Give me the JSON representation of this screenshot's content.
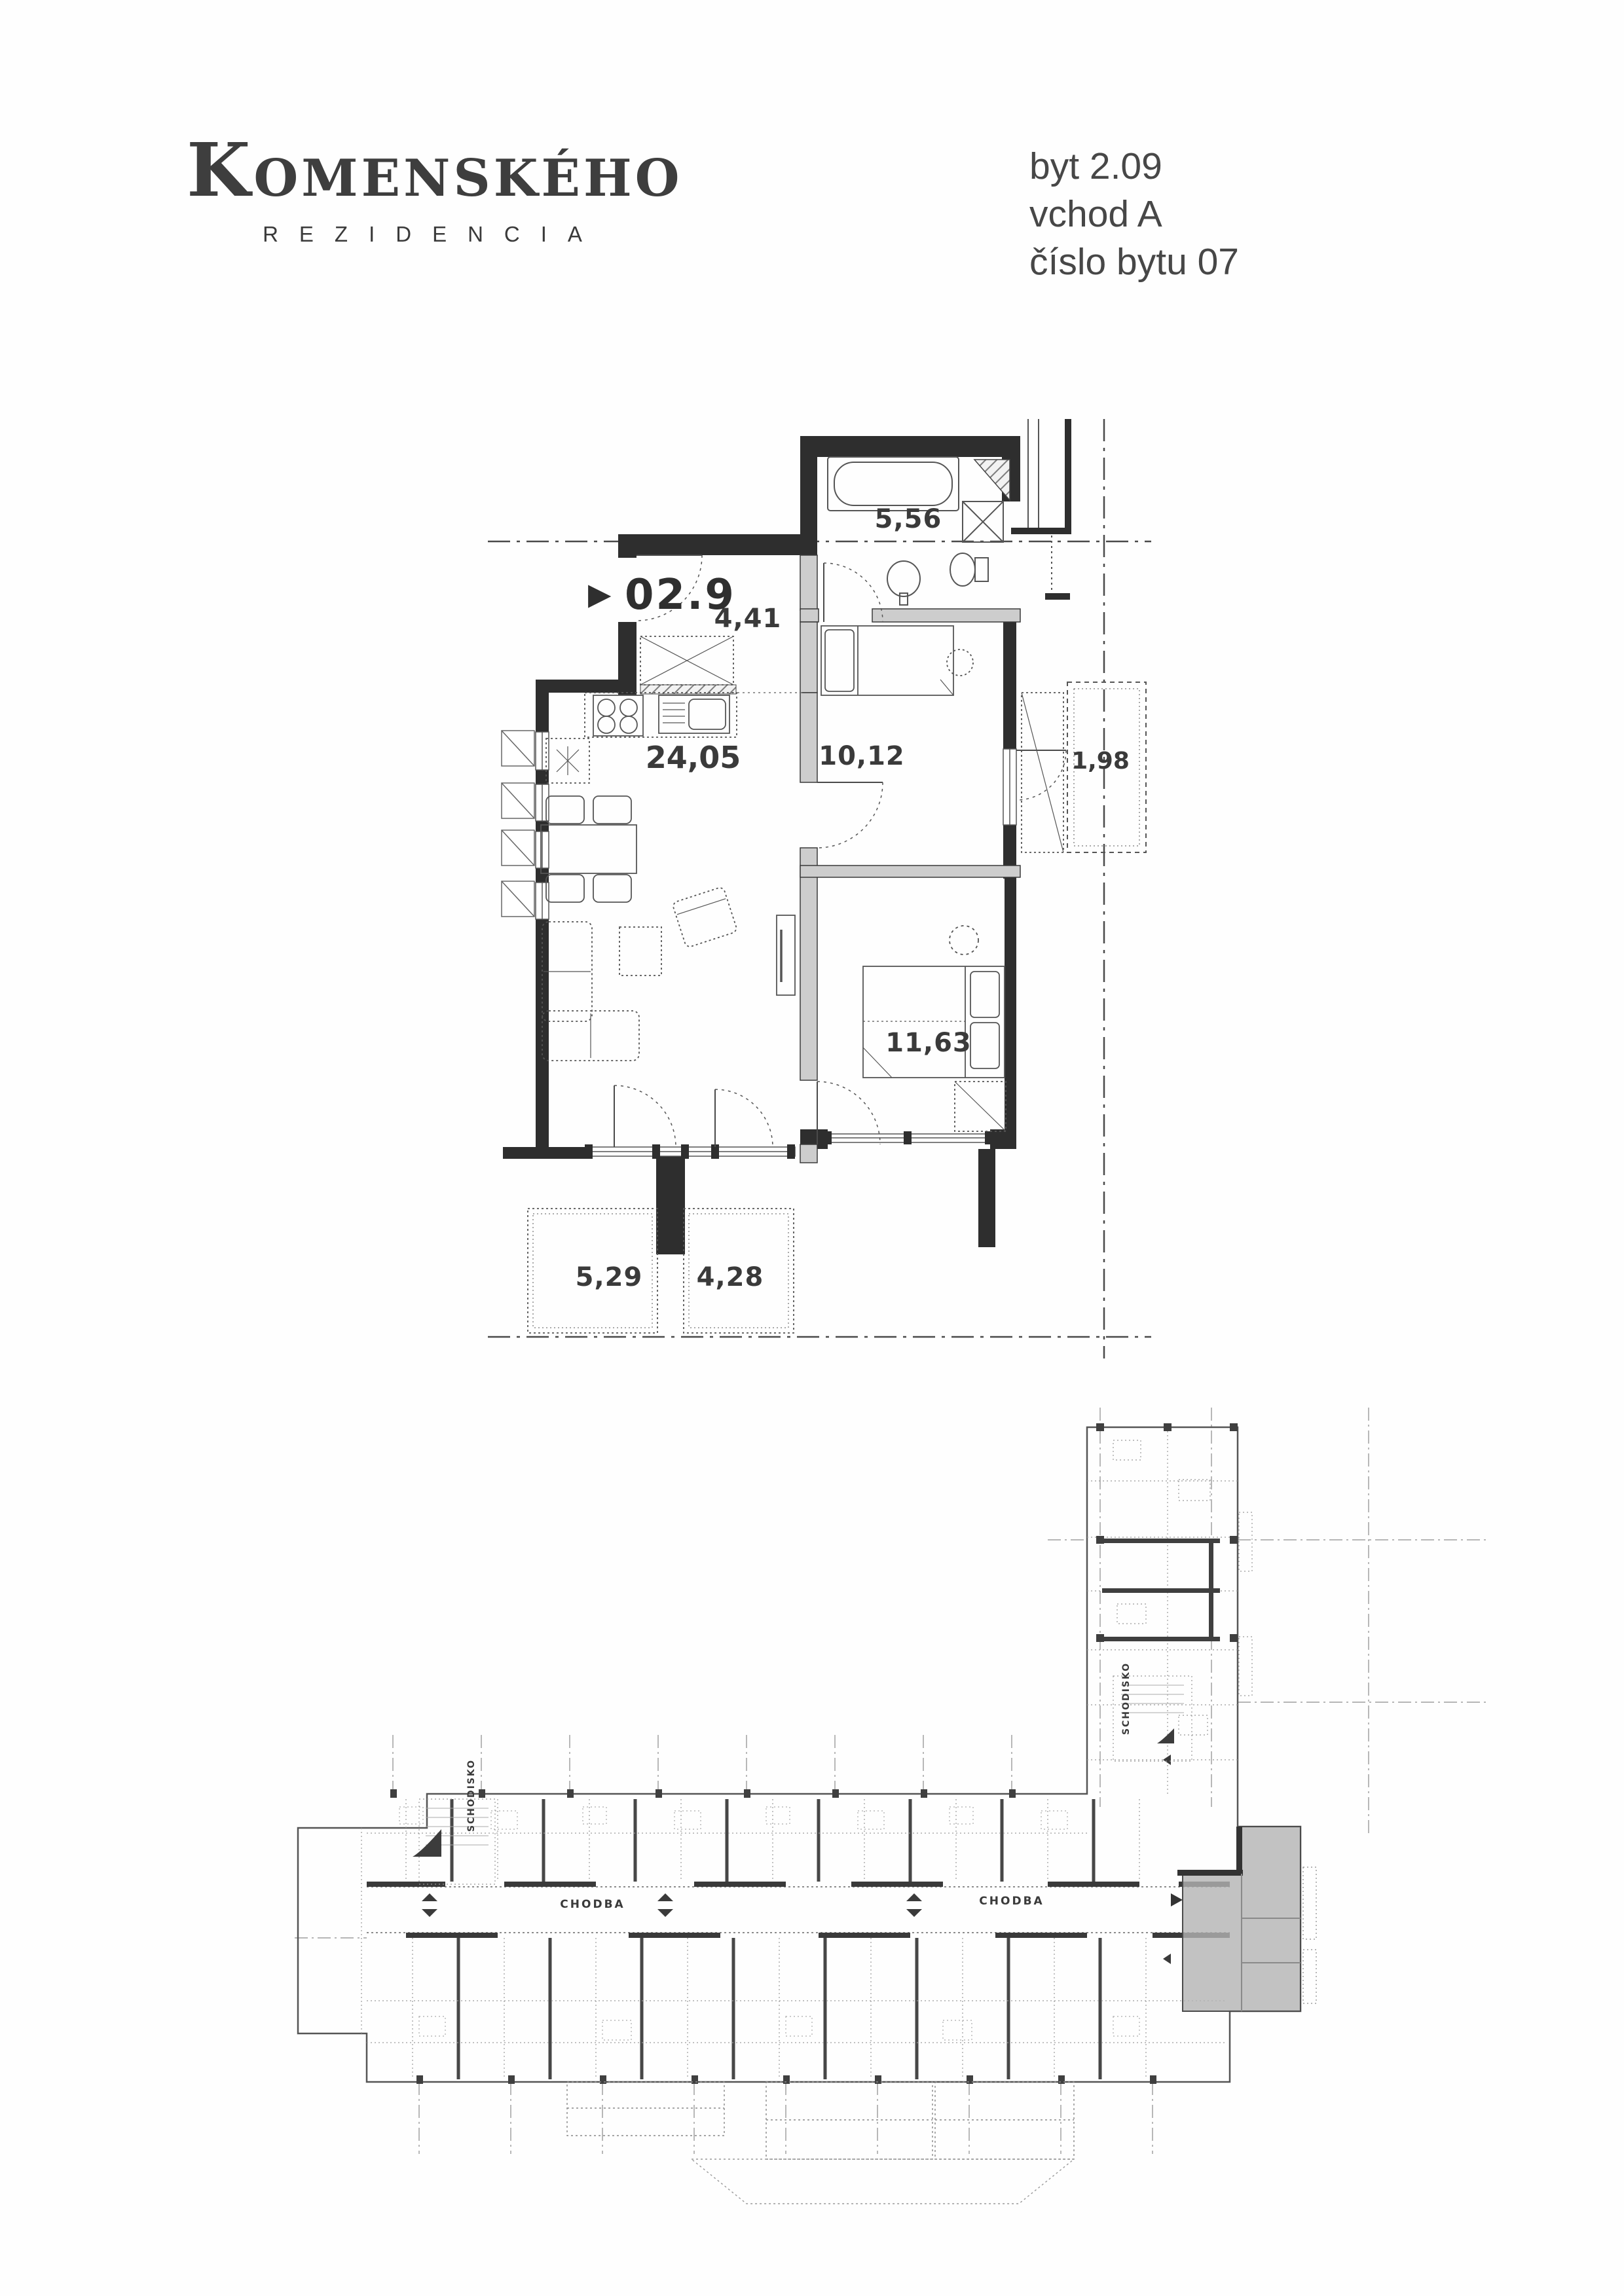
{
  "header": {
    "logo": {
      "title": "Komenského",
      "subtitle": "REZIDENCIA"
    },
    "unit_info": {
      "flat": "byt 2.09",
      "entrance": "vchod A",
      "flat_number": "číslo bytu 07"
    }
  },
  "unit_plan": {
    "unit_code": "02.9",
    "areas": {
      "bathroom": "5,56",
      "hall": "4,41",
      "bedroom_small": "10,12",
      "loggia": "1,98",
      "living_kitchen": "24,05",
      "bedroom_main": "11,63",
      "terrace_left": "5,29",
      "terrace_right": "4,28"
    }
  },
  "floor_overview": {
    "corridor_left": "CHODBA",
    "corridor_right": "CHODBA",
    "stairs_left": "SCHODISKO",
    "stairs_right": "SCHODISKO"
  },
  "icons": {
    "unit_pointer": "▶"
  },
  "colors": {
    "ink": "#3a3a3a",
    "wall": "#2e2e2e",
    "interior_wall": "#cdcdcd",
    "highlight": "#b3b3b3"
  }
}
